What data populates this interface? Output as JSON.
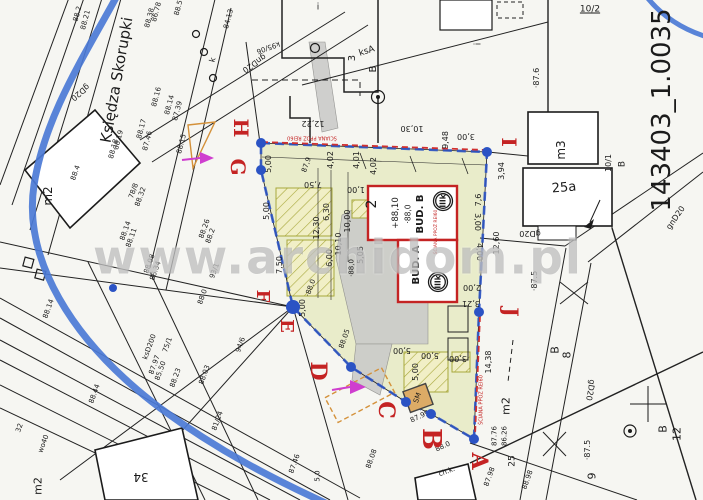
{
  "watermark": {
    "text": "www.archidom.pl"
  },
  "palette": {
    "paper": "#f6f6f2",
    "ink": "#1b1b1b",
    "parcel_fill": "#e9ecca",
    "hatch_olive": "#a8a83c",
    "road_blue": "#4b79d6",
    "boundary_blue": "#2b53c4",
    "red": "#c42323",
    "magenta": "#cf3ecf",
    "orange": "#d4913a",
    "gray_fill": "#cbcbc9",
    "watermark_gray": "#969696"
  },
  "map": {
    "street_label": "Księdza Skorupki",
    "sheet_id": "143403_1.0035",
    "fire_wall_note": "ŚCIANA PPOŻ REI60",
    "boundary_letters": [
      {
        "t": "H",
        "x": 241,
        "y": 128,
        "s": 20
      },
      {
        "t": "G",
        "x": 238,
        "y": 167,
        "s": 20
      },
      {
        "t": "F",
        "x": 262,
        "y": 296,
        "s": 18
      },
      {
        "t": "E",
        "x": 286,
        "y": 326,
        "s": 18
      },
      {
        "t": "D",
        "x": 318,
        "y": 371,
        "s": 22
      },
      {
        "t": "C",
        "x": 386,
        "y": 410,
        "s": 22
      },
      {
        "t": "B",
        "x": 431,
        "y": 439,
        "s": 26
      },
      {
        "t": "A",
        "x": 479,
        "y": 461,
        "s": 22
      },
      {
        "t": "I",
        "x": 509,
        "y": 142,
        "s": 20
      },
      {
        "t": "J",
        "x": 511,
        "y": 312,
        "s": 20
      }
    ],
    "corner_dots": [
      {
        "x": 261,
        "y": 143,
        "r": 5
      },
      {
        "x": 261,
        "y": 170,
        "r": 5
      },
      {
        "x": 293,
        "y": 307,
        "r": 7
      },
      {
        "x": 351,
        "y": 367,
        "r": 5
      },
      {
        "x": 406,
        "y": 402,
        "r": 5
      },
      {
        "x": 431,
        "y": 414,
        "r": 5
      },
      {
        "x": 474,
        "y": 439,
        "r": 5
      },
      {
        "x": 487,
        "y": 152,
        "r": 5
      },
      {
        "x": 479,
        "y": 312,
        "r": 5
      },
      {
        "x": 113,
        "y": 288,
        "r": 4
      }
    ],
    "labels": [
      {
        "t": "88.2",
        "x": 78,
        "y": 14,
        "r": -75,
        "s": 7
      },
      {
        "t": "88.21",
        "x": 86,
        "y": 20,
        "r": -75,
        "s": 7
      },
      {
        "t": "88.38",
        "x": 150,
        "y": 18,
        "r": -75,
        "s": 7
      },
      {
        "t": "86.78",
        "x": 157,
        "y": 12,
        "r": -75,
        "s": 7
      },
      {
        "t": "88.5",
        "x": 179,
        "y": 8,
        "r": -75,
        "s": 7
      },
      {
        "t": "84.13",
        "x": 229,
        "y": 19,
        "r": -75,
        "s": 7
      },
      {
        "t": "88.16",
        "x": 157,
        "y": 97,
        "r": -75,
        "s": 7
      },
      {
        "t": "88.14",
        "x": 170,
        "y": 105,
        "r": -75,
        "s": 7
      },
      {
        "t": "87.39",
        "x": 178,
        "y": 111,
        "r": -75,
        "s": 7
      },
      {
        "t": "88.17",
        "x": 142,
        "y": 129,
        "r": -75,
        "s": 7
      },
      {
        "t": "87.46",
        "x": 148,
        "y": 141,
        "r": -75,
        "s": 7
      },
      {
        "t": "88.19",
        "x": 119,
        "y": 140,
        "r": -75,
        "s": 7
      },
      {
        "t": "88.18",
        "x": 114,
        "y": 149,
        "r": -75,
        "s": 7
      },
      {
        "t": "88.15",
        "x": 182,
        "y": 144,
        "r": -75,
        "s": 7
      },
      {
        "t": "k",
        "x": 213,
        "y": 60,
        "r": -75,
        "s": 8
      },
      {
        "t": "gnD20",
        "x": 254,
        "y": 63,
        "r": 145,
        "s": 8
      },
      {
        "t": "k95/06",
        "x": 268,
        "y": 47,
        "r": 160,
        "s": 7
      },
      {
        "t": "gD20",
        "x": 80,
        "y": 92,
        "r": 140,
        "s": 8
      },
      {
        "t": "Księdza Skorupki",
        "x": 117,
        "y": 80,
        "r": -80,
        "s": 15
      },
      {
        "t": "m2",
        "x": 48,
        "y": 196,
        "r": -90,
        "s": 12
      },
      {
        "t": "m2",
        "x": 38,
        "y": 486,
        "r": -90,
        "s": 11
      },
      {
        "t": "m2",
        "x": 506,
        "y": 406,
        "r": -90,
        "s": 11
      },
      {
        "t": "m3",
        "x": 561,
        "y": 150,
        "r": -90,
        "s": 12
      },
      {
        "t": "25a",
        "x": 564,
        "y": 188,
        "r": -5,
        "s": 13
      },
      {
        "t": "34",
        "x": 141,
        "y": 477,
        "r": 180,
        "s": 12
      },
      {
        "t": "10/2",
        "x": 590,
        "y": 10,
        "r": 0,
        "s": 9,
        "u": 1
      },
      {
        "t": "10/1",
        "x": 609,
        "y": 163,
        "r": -90,
        "s": 8
      },
      {
        "t": "B",
        "x": 623,
        "y": 164,
        "r": -90,
        "s": 9
      },
      {
        "t": "B",
        "x": 555,
        "y": 350,
        "r": -90,
        "s": 11
      },
      {
        "t": "8",
        "x": 567,
        "y": 355,
        "r": -90,
        "s": 11
      },
      {
        "t": "B",
        "x": 663,
        "y": 429,
        "r": -90,
        "s": 11
      },
      {
        "t": "12",
        "x": 677,
        "y": 434,
        "r": -90,
        "s": 11
      },
      {
        "t": "i",
        "x": 318,
        "y": 8,
        "r": 0,
        "s": 9
      },
      {
        "t": "i",
        "x": 479,
        "y": 44,
        "r": -90,
        "s": 9
      },
      {
        "t": "3",
        "x": 353,
        "y": 58,
        "r": -90,
        "s": 10
      },
      {
        "t": "ksA",
        "x": 367,
        "y": 52,
        "r": -18,
        "s": 9
      },
      {
        "t": "B",
        "x": 374,
        "y": 69,
        "r": -90,
        "s": 10
      },
      {
        "t": "9",
        "x": 592,
        "y": 476,
        "r": -90,
        "s": 11
      },
      {
        "t": "25",
        "x": 513,
        "y": 461,
        "r": -90,
        "s": 9
      },
      {
        "t": "143403_1.0035",
        "x": 662,
        "y": 110,
        "r": -90,
        "s": 26
      },
      {
        "t": "88.4",
        "x": 76,
        "y": 173,
        "r": -70,
        "s": 7
      },
      {
        "t": "78/8",
        "x": 134,
        "y": 191,
        "r": -70,
        "s": 7
      },
      {
        "t": "88.32",
        "x": 141,
        "y": 197,
        "r": -70,
        "s": 7
      },
      {
        "t": "88.14",
        "x": 126,
        "y": 231,
        "r": -70,
        "s": 7
      },
      {
        "t": "88.11",
        "x": 132,
        "y": 238,
        "r": -70,
        "s": 7
      },
      {
        "t": "88.08",
        "x": 150,
        "y": 264,
        "r": -70,
        "s": 7
      },
      {
        "t": "86.34",
        "x": 156,
        "y": 271,
        "r": -70,
        "s": 7
      },
      {
        "t": "88.26",
        "x": 205,
        "y": 229,
        "r": -70,
        "s": 7
      },
      {
        "t": "88.2",
        "x": 211,
        "y": 236,
        "r": -70,
        "s": 7
      },
      {
        "t": "93/1",
        "x": 215,
        "y": 271,
        "r": -70,
        "s": 7
      },
      {
        "t": "88.0",
        "x": 203,
        "y": 297,
        "r": -70,
        "s": 7
      },
      {
        "t": "88.14",
        "x": 49,
        "y": 309,
        "r": -70,
        "s": 7
      },
      {
        "t": "88.44",
        "x": 95,
        "y": 394,
        "r": -70,
        "s": 7
      },
      {
        "t": "87.97",
        "x": 155,
        "y": 365,
        "r": -70,
        "s": 7
      },
      {
        "t": "85.50",
        "x": 161,
        "y": 371,
        "r": -70,
        "s": 7
      },
      {
        "t": "75/1",
        "x": 168,
        "y": 345,
        "r": -70,
        "s": 7
      },
      {
        "t": "88.23",
        "x": 176,
        "y": 378,
        "r": -70,
        "s": 7
      },
      {
        "t": "88.03",
        "x": 205,
        "y": 375,
        "r": -70,
        "s": 7
      },
      {
        "t": "81/24",
        "x": 218,
        "y": 421,
        "r": -70,
        "s": 7
      },
      {
        "t": "94/6",
        "x": 241,
        "y": 345,
        "r": -70,
        "s": 7
      },
      {
        "t": "ksD200",
        "x": 150,
        "y": 347,
        "r": -70,
        "s": 7
      },
      {
        "t": "wo40",
        "x": 44,
        "y": 444,
        "r": -70,
        "s": 7
      },
      {
        "t": "32",
        "x": 20,
        "y": 428,
        "r": -70,
        "s": 7
      },
      {
        "t": "88.05",
        "x": 345,
        "y": 339,
        "r": -70,
        "s": 7
      },
      {
        "t": "87.46",
        "x": 295,
        "y": 464,
        "r": -70,
        "s": 7
      },
      {
        "t": "88.08",
        "x": 372,
        "y": 459,
        "r": -70,
        "s": 7
      },
      {
        "t": "87.99",
        "x": 420,
        "y": 417,
        "r": -25,
        "s": 7
      },
      {
        "t": "88.0",
        "x": 443,
        "y": 447,
        "r": -25,
        "s": 7
      },
      {
        "t": "ch.k.",
        "x": 447,
        "y": 472,
        "r": -20,
        "s": 7
      },
      {
        "t": "87.76",
        "x": 495,
        "y": 436,
        "r": -90,
        "s": 7
      },
      {
        "t": "86.26",
        "x": 505,
        "y": 436,
        "r": -90,
        "s": 7
      },
      {
        "t": "87.98",
        "x": 490,
        "y": 477,
        "r": -70,
        "s": 7
      },
      {
        "t": "88.98",
        "x": 528,
        "y": 480,
        "r": -70,
        "s": 7
      },
      {
        "t": "gD20",
        "x": 530,
        "y": 233,
        "r": 180,
        "s": 8
      },
      {
        "t": "gnD20",
        "x": 676,
        "y": 218,
        "r": -55,
        "s": 8
      },
      {
        "t": "gD20",
        "x": 590,
        "y": 390,
        "r": 100,
        "s": 8
      },
      {
        "t": "·87.5",
        "x": 535,
        "y": 281,
        "r": -90,
        "s": 8
      },
      {
        "t": "·87.6",
        "x": 537,
        "y": 78,
        "r": -90,
        "s": 8
      },
      {
        "t": "·87.5",
        "x": 588,
        "y": 450,
        "r": -90,
        "s": 8
      },
      {
        "t": "12,22",
        "x": 313,
        "y": 123,
        "r": 180,
        "s": 8
      },
      {
        "t": "10,30",
        "x": 412,
        "y": 128,
        "r": 180,
        "s": 8
      },
      {
        "t": "9,48",
        "x": 446,
        "y": 140,
        "r": -90,
        "s": 8
      },
      {
        "t": "3,00",
        "x": 466,
        "y": 136,
        "r": 180,
        "s": 8
      },
      {
        "t": "5,00",
        "x": 269,
        "y": 164,
        "r": -90,
        "s": 8
      },
      {
        "t": "5,00",
        "x": 267,
        "y": 211,
        "r": -90,
        "s": 8
      },
      {
        "t": "87,9",
        "x": 307,
        "y": 165,
        "r": -70,
        "s": 7
      },
      {
        "t": "7,50",
        "x": 313,
        "y": 184,
        "r": 180,
        "s": 8
      },
      {
        "t": "4,02",
        "x": 331,
        "y": 160,
        "r": -90,
        "s": 8
      },
      {
        "t": "4,01",
        "x": 357,
        "y": 160,
        "r": -90,
        "s": 8
      },
      {
        "t": "4,02",
        "x": 374,
        "y": 166,
        "r": -90,
        "s": 8
      },
      {
        "t": "1,00",
        "x": 356,
        "y": 189,
        "r": 180,
        "s": 8
      },
      {
        "t": "6,30",
        "x": 327,
        "y": 212,
        "r": -90,
        "s": 8
      },
      {
        "t": "12,30",
        "x": 317,
        "y": 228,
        "r": -90,
        "s": 8
      },
      {
        "t": "10,00",
        "x": 348,
        "y": 221,
        "r": -90,
        "s": 8
      },
      {
        "t": "10,10",
        "x": 339,
        "y": 244,
        "r": -90,
        "s": 8
      },
      {
        "t": "6,00",
        "x": 330,
        "y": 258,
        "r": -90,
        "s": 8
      },
      {
        "t": "5,05",
        "x": 361,
        "y": 255,
        "r": -90,
        "s": 8
      },
      {
        "t": "·88,0",
        "x": 352,
        "y": 268,
        "r": -90,
        "s": 7
      },
      {
        "t": "7,50",
        "x": 280,
        "y": 265,
        "r": -90,
        "s": 8
      },
      {
        "t": "5,00",
        "x": 303,
        "y": 308,
        "r": -90,
        "s": 8
      },
      {
        "t": "·88,0",
        "x": 311,
        "y": 288,
        "r": -70,
        "s": 7
      },
      {
        "t": "5,00",
        "x": 402,
        "y": 350,
        "r": 180,
        "s": 8
      },
      {
        "t": "5,00",
        "x": 430,
        "y": 355,
        "r": 180,
        "s": 8
      },
      {
        "t": "3,00",
        "x": 458,
        "y": 358,
        "r": 180,
        "s": 8
      },
      {
        "t": "5,00",
        "x": 416,
        "y": 372,
        "r": -90,
        "s": 8
      },
      {
        "t": "2,00",
        "x": 472,
        "y": 287,
        "r": 180,
        "s": 8
      },
      {
        "t": "3,21",
        "x": 471,
        "y": 303,
        "r": 180,
        "s": 8
      },
      {
        "t": "3,00",
        "x": 477,
        "y": 222,
        "r": 90,
        "s": 8
      },
      {
        "t": "4,00",
        "x": 479,
        "y": 252,
        "r": 90,
        "s": 8
      },
      {
        "t": "14,38",
        "x": 489,
        "y": 362,
        "r": -90,
        "s": 8
      },
      {
        "t": "12,60",
        "x": 497,
        "y": 243,
        "r": -90,
        "s": 8
      },
      {
        "t": "3,94",
        "x": 502,
        "y": 171,
        "r": -90,
        "s": 8
      },
      {
        "t": "7,6",
        "x": 479,
        "y": 200,
        "r": -90,
        "s": 8
      },
      {
        "t": "5,0",
        "x": 318,
        "y": 476,
        "r": -90,
        "s": 7
      },
      {
        "t": "BUD. B",
        "x": 421,
        "y": 214,
        "r": -90,
        "s": 10,
        "b": 1
      },
      {
        "t": "BUD. A",
        "x": 417,
        "y": 265,
        "r": -90,
        "s": 10,
        "b": 1
      },
      {
        "t": "·88,0",
        "x": 408,
        "y": 214,
        "r": -90,
        "s": 7.5
      },
      {
        "t": "+88,10",
        "x": 396,
        "y": 213,
        "r": -90,
        "s": 8.5
      },
      {
        "t": "2",
        "x": 372,
        "y": 204,
        "r": -90,
        "s": 14
      },
      {
        "t": "IIIk",
        "x": 443,
        "y": 201,
        "r": -90,
        "s": 7.5,
        "b": 1
      },
      {
        "t": "IIIk",
        "x": 438,
        "y": 282,
        "r": -90,
        "s": 7.5,
        "b": 1
      },
      {
        "t": "SM",
        "x": 418,
        "y": 398,
        "r": -70,
        "s": 7
      },
      {
        "t": "ŚCIANA PPOŻ REI60",
        "x": 312,
        "y": 137,
        "r": 180,
        "s": 5,
        "c": "red"
      },
      {
        "t": "ŚCIANA PPOŻ REI60",
        "x": 437,
        "y": 232,
        "r": -90,
        "s": 4.5,
        "c": "red"
      },
      {
        "t": "ŚCIANA PPOŻ REI60",
        "x": 482,
        "y": 400,
        "r": -90,
        "s": 5,
        "c": "red"
      }
    ]
  }
}
